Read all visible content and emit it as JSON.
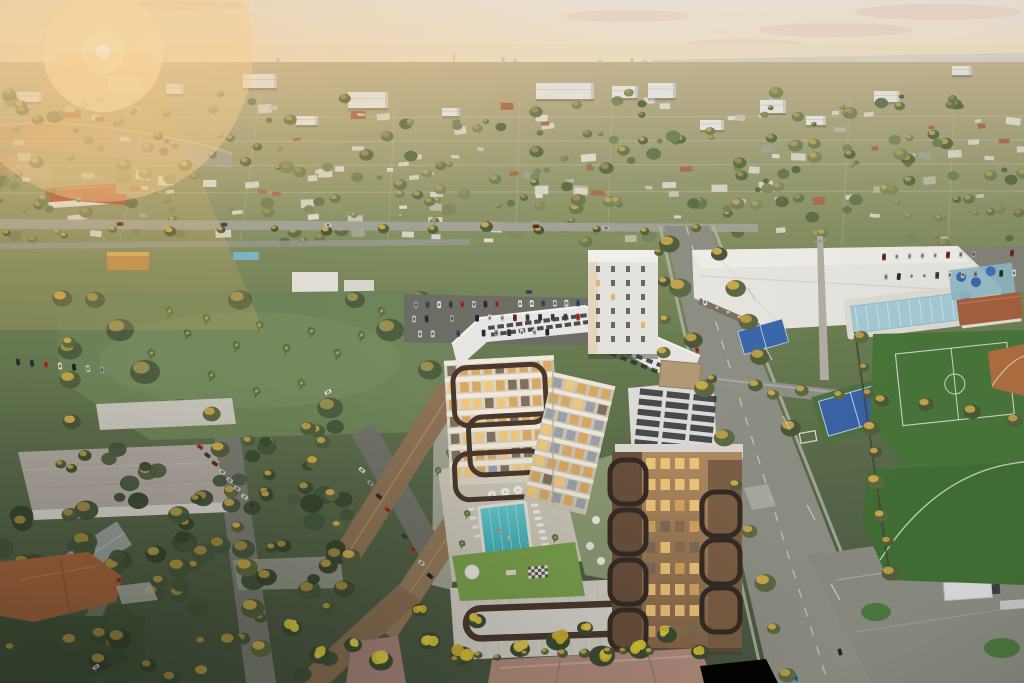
{
  "meta": {
    "title": "Aerial sunset rendering of a mixed-use condominium beside a community aquatic park",
    "setting": "South Florida suburb at golden hour, elevated drone view toward a hazy distant skyline",
    "time_of_day": "sunset"
  },
  "palette": {
    "sky_top": "#efe7dc",
    "sky_horizon": "#f6d9ae",
    "sun_core": "#fffef6",
    "sun_glow": "#ffe9c0",
    "haze": "#ecdfc6",
    "skyline": "#c9bdab",
    "water": "#ced2d2",
    "lake_warm": "#c29b6c",
    "lake_cool": "#a3a796",
    "road": "#8e9086",
    "road_dark": "#7b7d73",
    "asphalt": "#6d6f67",
    "sidewalk": "#b7b8ae",
    "marking": "#d9dad0",
    "building_white": "#e9e7e1",
    "building_shadow": "#cfccc4",
    "facade_cream": "#ded6c5",
    "floor_band": "#f2ecdf",
    "window_lit": "#f3c87a",
    "window_warm": "#d9a660",
    "window_dim": "#7c6b58",
    "glass_cool": "#97a0a9",
    "frame_brown": "#4a382e",
    "frame_dark": "#352b24",
    "tower_tan": "#a5825c",
    "tower_dark": "#6a503c",
    "roof_white": "#e9e7e3",
    "roof_panel": "#2d3134",
    "penthouse": "#b59b77",
    "pool_teal": "#4fbec4",
    "pool_deep": "#3dadb9",
    "lane_line": "#c2eef0",
    "deck": "#cfcabc",
    "lawn": "#7aa24d",
    "lap_pool": "#a7ccd8",
    "court_blue": "#3c68ad",
    "field_green": "#44703a",
    "clay": "#b06f41",
    "terracotta_roof": "#b2593a",
    "mauve_roof": "#b18c7e",
    "tan_roof": "#91765a",
    "orange_roof": "#a9663e",
    "tree_olive": "#6e7f52",
    "tree_dark": "#46573c",
    "tree_gold": "#c9a84e",
    "bloom_yellow": "#d8c437",
    "podium": "#d3d0c7",
    "trailer": "#dcdedf"
  },
  "sun": {
    "x": 103,
    "y": 52
  },
  "clouds": [
    [
      628,
      16,
      64,
      6
    ],
    [
      836,
      30,
      78,
      7
    ],
    [
      938,
      12,
      84,
      8
    ],
    [
      744,
      44,
      60,
      5
    ],
    [
      180,
      6,
      70,
      5
    ]
  ],
  "skyline": [
    [
      60,
      4
    ],
    [
      138,
      5
    ],
    [
      210,
      4
    ],
    [
      278,
      8
    ],
    [
      300,
      4
    ],
    [
      410,
      5
    ],
    [
      455,
      13
    ],
    [
      503,
      9
    ],
    [
      515,
      7
    ],
    [
      552,
      5
    ],
    [
      600,
      6
    ],
    [
      632,
      8
    ],
    [
      645,
      6
    ],
    [
      680,
      5
    ],
    [
      742,
      7
    ],
    [
      756,
      5
    ],
    [
      820,
      5
    ],
    [
      902,
      9
    ],
    [
      906,
      12
    ],
    [
      918,
      7
    ],
    [
      965,
      5
    ],
    [
      1002,
      6
    ]
  ],
  "fine_streets": {
    "h": [
      118,
      142,
      166,
      193
    ],
    "v": [
      [
        150,
        95,
        120,
        240
      ],
      [
        260,
        95,
        240,
        242
      ],
      [
        395,
        95,
        388,
        246
      ],
      [
        520,
        92,
        516,
        230
      ],
      [
        612,
        92,
        608,
        230
      ],
      [
        850,
        95,
        842,
        245
      ],
      [
        955,
        92,
        948,
        240
      ]
    ]
  },
  "midrises": [
    [
      108,
      76,
      34,
      16
    ],
    [
      166,
      84,
      18,
      10
    ],
    [
      243,
      74,
      34,
      14
    ],
    [
      348,
      92,
      40,
      16
    ],
    [
      536,
      83,
      58,
      16
    ],
    [
      612,
      86,
      26,
      12
    ],
    [
      648,
      83,
      28,
      15
    ],
    [
      760,
      100,
      26,
      13
    ],
    [
      874,
      91,
      26,
      11
    ],
    [
      952,
      66,
      20,
      9
    ],
    [
      14,
      92,
      28,
      10
    ],
    [
      442,
      108,
      18,
      8
    ],
    [
      296,
      116,
      22,
      9
    ],
    [
      700,
      120,
      24,
      10
    ],
    [
      806,
      116,
      20,
      9
    ]
  ],
  "scatter": {
    "mid_trees": {
      "seed": 7,
      "count": 240,
      "x": 0,
      "y": 92,
      "w": 1024,
      "h": 152,
      "rmin": 2.5,
      "rmax": 7.5
    },
    "mid_houses": {
      "seed": 11,
      "count": 130,
      "x": 0,
      "y": 97,
      "w": 1024,
      "h": 142,
      "wmin": 6,
      "wmax": 16
    },
    "low_trees": {
      "seed": 5,
      "count": 70,
      "x": 0,
      "y": 495,
      "w": 352,
      "h": 186,
      "rmin": 6,
      "rmax": 13
    },
    "mid_low_trees": {
      "seed": 9,
      "count": 30,
      "x": 60,
      "y": 425,
      "w": 300,
      "h": 85,
      "rmin": 5,
      "rmax": 10
    }
  },
  "tree_rows": [
    {
      "x1": 668,
      "y1": 242,
      "x2": 788,
      "y2": 678,
      "n": 10,
      "r": 9
    },
    {
      "x1": 718,
      "y1": 252,
      "x2": 788,
      "y2": 428,
      "n": 6,
      "r": 8
    },
    {
      "x1": 712,
      "y1": 380,
      "x2": 1016,
      "y2": 418,
      "n": 8,
      "r": 7
    },
    {
      "x1": 214,
      "y1": 412,
      "x2": 262,
      "y2": 648,
      "n": 7,
      "r": 9
    },
    {
      "x1": 10,
      "y1": 233,
      "x2": 700,
      "y2": 228,
      "n": 14,
      "r": 5
    },
    {
      "x1": 858,
      "y1": 338,
      "x2": 892,
      "y2": 572,
      "n": 9,
      "r": 7
    },
    {
      "x1": 66,
      "y1": 300,
      "x2": 70,
      "y2": 420,
      "n": 4,
      "r": 9
    },
    {
      "x1": 458,
      "y1": 657,
      "x2": 648,
      "y2": 649,
      "n": 10,
      "r": 5
    },
    {
      "x1": 662,
      "y1": 250,
      "x2": 662,
      "y2": 352,
      "n": 4,
      "r": 6
    },
    {
      "x1": 306,
      "y1": 430,
      "x2": 352,
      "y2": 560,
      "n": 5,
      "r": 8
    }
  ],
  "park": {
    "palms": [
      [
        168,
        318
      ],
      [
        186,
        340
      ],
      [
        205,
        325
      ],
      [
        235,
        352
      ],
      [
        258,
        332
      ],
      [
        285,
        355
      ],
      [
        310,
        338
      ],
      [
        336,
        360
      ],
      [
        360,
        342
      ],
      [
        300,
        390
      ],
      [
        255,
        398
      ],
      [
        210,
        382
      ],
      [
        380,
        318
      ],
      [
        150,
        360
      ]
    ],
    "trees": [
      [
        120,
        330,
        14
      ],
      [
        145,
        372,
        15
      ],
      [
        390,
        330,
        14
      ],
      [
        420,
        300,
        11
      ],
      [
        95,
        300,
        10
      ],
      [
        70,
        350,
        12
      ],
      [
        430,
        370,
        12
      ],
      [
        180,
        408,
        11
      ],
      [
        330,
        408,
        13
      ],
      [
        240,
        300,
        12
      ],
      [
        355,
        300,
        10
      ]
    ]
  },
  "deck_palms": [
    [
      466,
      519
    ],
    [
      461,
      549
    ],
    [
      545,
      500
    ],
    [
      554,
      543
    ],
    [
      437,
      476
    ],
    [
      448,
      458
    ]
  ],
  "bloom_trees": [
    [
      430,
      641,
      11
    ],
    [
      462,
      656,
      12
    ],
    [
      520,
      649,
      10
    ],
    [
      558,
      641,
      12
    ],
    [
      602,
      656,
      13
    ],
    [
      640,
      650,
      11
    ],
    [
      477,
      621,
      9
    ],
    [
      381,
      661,
      12
    ],
    [
      353,
      645,
      9
    ],
    [
      667,
      635,
      10
    ],
    [
      700,
      652,
      9
    ],
    [
      420,
      610,
      8
    ],
    [
      585,
      628,
      8
    ],
    [
      292,
      628,
      10
    ],
    [
      320,
      655,
      11
    ]
  ],
  "car_rows": [
    {
      "x1": 416,
      "y1": 305,
      "x2": 578,
      "y2": 303,
      "n": 15,
      "a": 88
    },
    {
      "x1": 414,
      "y1": 319,
      "x2": 578,
      "y2": 317,
      "n": 14,
      "a": 88
    },
    {
      "x1": 420,
      "y1": 334,
      "x2": 560,
      "y2": 332,
      "n": 12,
      "a": 88
    },
    {
      "x1": 884,
      "y1": 257,
      "x2": 1012,
      "y2": 253,
      "n": 11,
      "a": 95
    },
    {
      "x1": 886,
      "y1": 277,
      "x2": 1014,
      "y2": 273,
      "n": 11,
      "a": 95
    },
    {
      "x1": 18,
      "y1": 362,
      "x2": 102,
      "y2": 370,
      "n": 7,
      "a": 80
    },
    {
      "x1": 200,
      "y1": 447,
      "x2": 252,
      "y2": 505,
      "n": 8,
      "a": 35
    },
    {
      "x1": 362,
      "y1": 470,
      "x2": 430,
      "y2": 576,
      "n": 9,
      "a": 40
    },
    {
      "x1": 120,
      "y1": 224,
      "x2": 640,
      "y2": 227,
      "n": 6,
      "a": 0
    }
  ],
  "cars": [
    {
      "x": 697,
      "y": 350,
      "a": 78,
      "c": "#b23b2d"
    },
    {
      "x": 119,
      "y": 580,
      "a": -32,
      "c": "#b23b2d"
    },
    {
      "x": 328,
      "y": 392,
      "a": -28,
      "c": "#e8e9e5"
    },
    {
      "x": 840,
      "y": 652,
      "a": 75,
      "c": "#23272c"
    },
    {
      "x": 796,
      "y": 678,
      "a": 75,
      "c": "#2e7f96"
    },
    {
      "x": 96,
      "y": 667,
      "a": -35,
      "c": "#dfe0dc"
    },
    {
      "x": 705,
      "y": 302,
      "a": 80,
      "c": "#e8e9e5"
    },
    {
      "x": 529,
      "y": 292,
      "a": 0,
      "c": "#3d5270"
    },
    {
      "x": 606,
      "y": 228,
      "a": 0,
      "c": "#b9bcc0"
    }
  ],
  "facades": {
    "sw": {
      "x": 447,
      "y": 358,
      "w": 110,
      "floors": 7,
      "step": 17,
      "cols": 9,
      "rot": -3,
      "cx": 500,
      "cy": 420
    },
    "se": {
      "x": 553,
      "y": 372,
      "w": 64,
      "floors": 8,
      "step": 16,
      "cols": 5,
      "rot": 13,
      "cx": 553,
      "cy": 372
    },
    "tower": {
      "x": 646,
      "y": 458,
      "cols": 4,
      "rows": 9,
      "sx": 14.5,
      "sy": 21,
      "w": 9.5,
      "h": 11
    }
  },
  "frames": {
    "sw": [
      [
        455,
        366,
        92,
        58
      ],
      [
        468,
        416,
        96,
        58
      ],
      [
        452,
        452,
        88,
        46
      ]
    ],
    "tower_left": [
      [
        610,
        460,
        36,
        44
      ],
      [
        610,
        510,
        36,
        44
      ],
      [
        610,
        560,
        36,
        44
      ],
      [
        610,
        610,
        36,
        40
      ]
    ],
    "tower_right": [
      [
        702,
        492,
        38,
        44
      ],
      [
        702,
        540,
        38,
        44
      ],
      [
        702,
        588,
        38,
        44
      ]
    ],
    "podium_sign": [
      466,
      606,
      166,
      30
    ]
  },
  "car_colors": [
    "#e8e9e5",
    "#dfe0dc",
    "#2f3438",
    "#41484f",
    "#b23b2d",
    "#3d5270",
    "#9aa0a6",
    "#c4c6c2",
    "#22262a",
    "#cfd0cc",
    "#7d2f26"
  ]
}
